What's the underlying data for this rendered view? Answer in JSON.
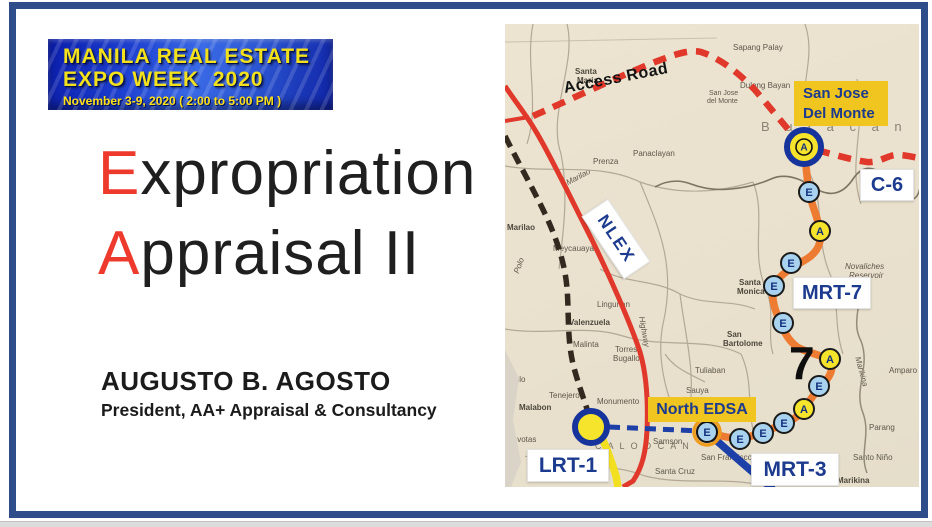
{
  "banner": {
    "line1": "MANILA REAL ESTATE",
    "line2": "EXPO WEEK  2020",
    "line3": "November 3-9, 2020 ( 2:00 to 5:00 PM )"
  },
  "title": {
    "lines": [
      {
        "initial": "E",
        "rest": "xpropriation"
      },
      {
        "initial": "A",
        "rest": "ppraisal II"
      }
    ],
    "accent_color": "#ee3a2c"
  },
  "author": {
    "name": "AUGUSTO B. AGOSTO",
    "role": "President, AA+ Appraisal & Consultancy"
  },
  "chrome": {
    "border_color": "#2e4d8a"
  },
  "map": {
    "route_labels": {
      "access_road": "Access Road",
      "nlex": "NLEX",
      "c6": "C-6",
      "mrt7": "MRT-7",
      "mrt3": "MRT-3",
      "lrt1": "LRT-1",
      "north_edsa": "North EDSA",
      "sjdm_line1": "San Jose",
      "sjdm_line2": "Del Monte",
      "seven": "7"
    },
    "colors": {
      "map_bg": "#eae2cf",
      "red_line": "#e0382b",
      "rail_black": "#33291f",
      "mrt7_orange": "#ee7b32",
      "mrt3_blue": "#1c3fa8",
      "lrt1_yellow": "#f2df1f",
      "station_e_fill": "#a8d2ee",
      "station_a_fill": "#f6e42c",
      "station_letter": "#13307e",
      "terminal_ring": "#16349b",
      "interchange_ring": "#ef9b1d",
      "label_yellow_bg": "#f1c51f",
      "label_navy": "#1c3a8e",
      "road_gray": "#b3a896",
      "boundary_gray": "#7d7362",
      "river_gray": "#958b78"
    },
    "stations": [
      {
        "letter": "E",
        "x": 304,
        "y": 168
      },
      {
        "letter": "A",
        "x": 315,
        "y": 207
      },
      {
        "letter": "E",
        "x": 286,
        "y": 239
      },
      {
        "letter": "E",
        "x": 269,
        "y": 262
      },
      {
        "letter": "E",
        "x": 278,
        "y": 299
      },
      {
        "letter": "A",
        "x": 325,
        "y": 335
      },
      {
        "letter": "E",
        "x": 314,
        "y": 362
      },
      {
        "letter": "A",
        "x": 299,
        "y": 385
      },
      {
        "letter": "E",
        "x": 279,
        "y": 399
      },
      {
        "letter": "E",
        "x": 258,
        "y": 409
      },
      {
        "letter": "E",
        "x": 235,
        "y": 415
      }
    ],
    "terminals": [
      {
        "id": "san-jose-del-monte",
        "letter": "A",
        "x": 299,
        "y": 123,
        "style": "terminal-a"
      },
      {
        "id": "monumento",
        "letter": "",
        "x": 86,
        "y": 403,
        "style": "terminal"
      },
      {
        "id": "north-edsa",
        "letter": "E",
        "x": 202,
        "y": 408,
        "style": "interchange-e"
      }
    ],
    "place_names": [
      {
        "t": "Santa",
        "x": 70,
        "y": 44,
        "b": 1
      },
      {
        "t": "Maria",
        "x": 72,
        "y": 53,
        "b": 1
      },
      {
        "t": "Sapang Palay",
        "x": 228,
        "y": 20
      },
      {
        "t": "Dulong Bayan",
        "x": 235,
        "y": 58
      },
      {
        "t": "B u l a c a n",
        "x": 256,
        "y": 96,
        "s": 13,
        "c": "#8a8274",
        "sp": 6
      },
      {
        "t": "San Jose",
        "x": 204,
        "y": 66,
        "s": 7
      },
      {
        "t": "del Monte",
        "x": 202,
        "y": 74,
        "s": 7
      },
      {
        "t": "Panaclayan",
        "x": 128,
        "y": 126
      },
      {
        "t": "Prenza",
        "x": 88,
        "y": 134
      },
      {
        "t": "Marilao",
        "x": 2,
        "y": 200,
        "b": 1
      },
      {
        "t": "Marilao",
        "x": 60,
        "y": 156,
        "i": 1,
        "r": -28
      },
      {
        "t": "Meycauayan",
        "x": 48,
        "y": 221
      },
      {
        "t": "Lingunan",
        "x": 92,
        "y": 277
      },
      {
        "t": "Valenzuela",
        "x": 64,
        "y": 295,
        "b": 1
      },
      {
        "t": "Malinta",
        "x": 68,
        "y": 317
      },
      {
        "t": "Torres",
        "x": 110,
        "y": 322
      },
      {
        "t": "Bugallon",
        "x": 108,
        "y": 331
      },
      {
        "t": "Hulo",
        "x": 4,
        "y": 352
      },
      {
        "t": "Tenejeros",
        "x": 44,
        "y": 368
      },
      {
        "t": "Malabon",
        "x": 14,
        "y": 380,
        "b": 1
      },
      {
        "t": "Navotas",
        "x": 2,
        "y": 412
      },
      {
        "t": "C A L O O C A N",
        "x": 90,
        "y": 418,
        "s": 9,
        "sp": 2,
        "c": "#7c7262"
      },
      {
        "t": "Monumento",
        "x": 92,
        "y": 374
      },
      {
        "t": "Samson",
        "x": 148,
        "y": 414
      },
      {
        "t": "San Francisco",
        "x": 196,
        "y": 430
      },
      {
        "t": "Santa Cruz",
        "x": 150,
        "y": 444
      },
      {
        "t": "Tuliaban",
        "x": 190,
        "y": 343
      },
      {
        "t": "Sauya",
        "x": 181,
        "y": 363
      },
      {
        "t": "Santa",
        "x": 234,
        "y": 255,
        "b": 1
      },
      {
        "t": "Monica",
        "x": 232,
        "y": 264,
        "b": 1
      },
      {
        "t": "San",
        "x": 222,
        "y": 307,
        "b": 1
      },
      {
        "t": "Bartolome",
        "x": 218,
        "y": 316,
        "b": 1
      },
      {
        "t": "Novaliches",
        "x": 340,
        "y": 239,
        "i": 1
      },
      {
        "t": "Reservoir",
        "x": 344,
        "y": 248,
        "i": 1
      },
      {
        "t": "Parang",
        "x": 364,
        "y": 400
      },
      {
        "t": "Santo Niño",
        "x": 348,
        "y": 430
      },
      {
        "t": "Marikina",
        "x": 332,
        "y": 453,
        "b": 1
      },
      {
        "t": "Marikina",
        "x": 356,
        "y": 332,
        "i": 1,
        "r": 75
      },
      {
        "t": "Amparo",
        "x": 384,
        "y": 343
      },
      {
        "t": "Highway",
        "x": 140,
        "y": 292,
        "i": 1,
        "r": 80
      },
      {
        "t": "Polo",
        "x": 8,
        "y": 248,
        "i": 1,
        "r": -70
      }
    ]
  }
}
